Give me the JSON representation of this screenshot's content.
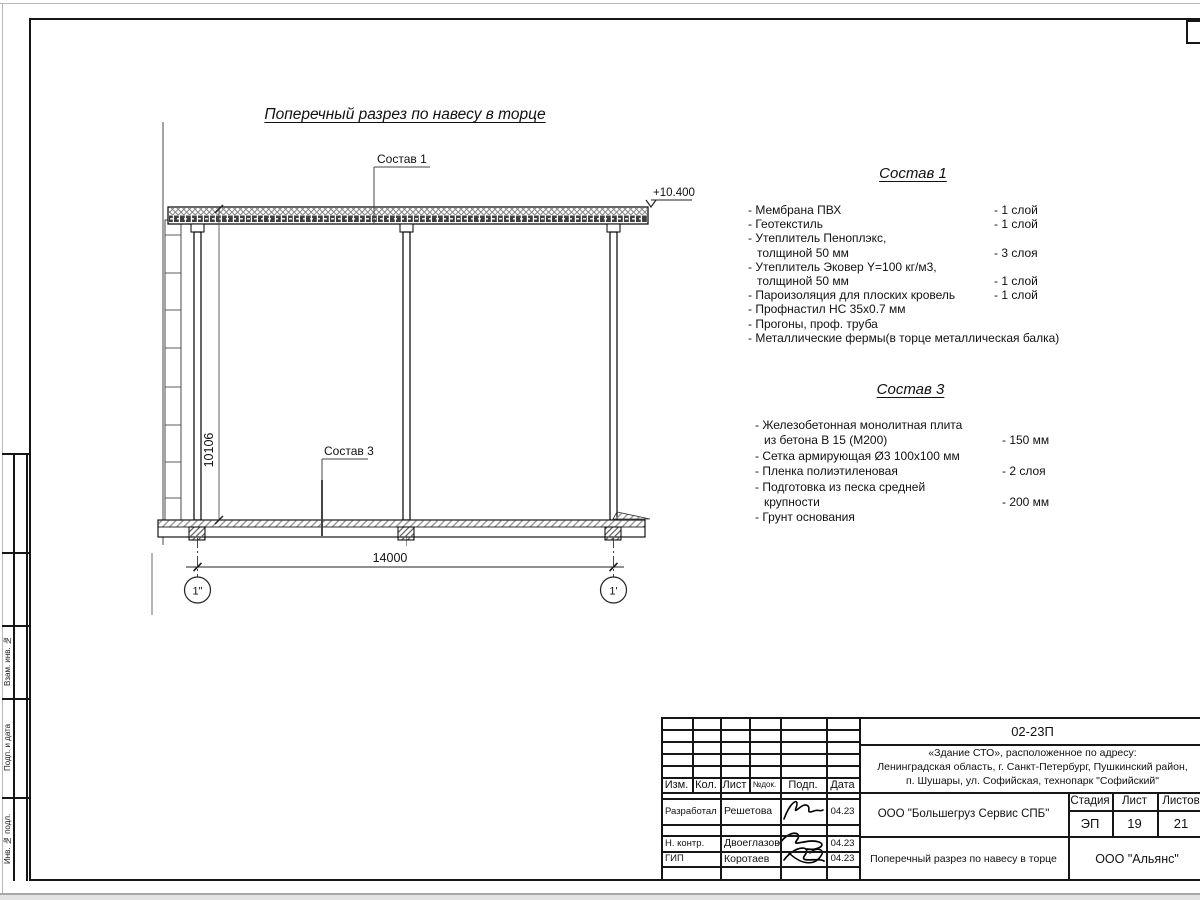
{
  "drawing": {
    "title": "Поперечный разрез по навесу в торце",
    "sostav1_ref": "Состав 1",
    "sostav3_ref": "Состав 3",
    "elevation": "+10.400",
    "dim_width": "14000",
    "dim_height": "10106",
    "axis_left": "1\"",
    "axis_right": "1'"
  },
  "sostav1": {
    "title": "Состав 1",
    "items": [
      {
        "lines": [
          "Мембрана ПВХ"
        ],
        "qty": "- 1 слой"
      },
      {
        "lines": [
          "Геотекстиль"
        ],
        "qty": "- 1 слой"
      },
      {
        "lines": [
          "Утеплитель Пеноплэкс,",
          "толщиной 50 мм"
        ],
        "qty": "- 3 слоя"
      },
      {
        "lines": [
          "Утеплитель Эковер Y=100 кг/м3,",
          "толщиной 50 мм"
        ],
        "qty": "- 1 слой"
      },
      {
        "lines": [
          "Пароизоляция для плоских кровель"
        ],
        "qty": "- 1 слой"
      },
      {
        "lines": [
          "Профнастил НС 35х0.7 мм"
        ],
        "qty": ""
      },
      {
        "lines": [
          "Прогоны, проф. труба"
        ],
        "qty": ""
      },
      {
        "lines": [
          "Металлические фермы(в торце металлическая балка)"
        ],
        "qty": ""
      }
    ]
  },
  "sostav3": {
    "title": "Состав 3",
    "items": [
      {
        "lines": [
          "Железобетонная  монолитная плита",
          "из бетона В 15 (М200)"
        ],
        "qty": "- 150 мм"
      },
      {
        "lines": [
          "Сетка армирующая Ø3 100х100 мм"
        ],
        "qty": ""
      },
      {
        "lines": [
          "Пленка полиэтиленовая"
        ],
        "qty": "-  2 слоя"
      },
      {
        "lines": [
          "Подготовка из песка средней",
          "крупности"
        ],
        "qty": "- 200 мм"
      },
      {
        "lines": [
          "Грунт основания"
        ],
        "qty": ""
      }
    ]
  },
  "titleblock": {
    "doc_number": "02-23П",
    "object_lines": [
      "«Здание СТО», расположенное по адресу:",
      "Ленинградская область, г. Санкт-Петербург, Пушкинский район,",
      "п. Шушары, ул. Софийская, технопарк \"Софийский\""
    ],
    "header": {
      "izm": "Изм.",
      "kol": "Кол.",
      "list": "Лист",
      "ndok": "№док.",
      "podp": "Подп.",
      "data": "Дата"
    },
    "rows": [
      {
        "role": "Разработал",
        "name": "Решетова",
        "date": "04.23"
      },
      {
        "role": "Н. контр.",
        "name": "Двоеглазов",
        "date": "04.23"
      },
      {
        "role": "ГИП",
        "name": "Коротаев",
        "date": "04.23"
      }
    ],
    "org": "ООО \"Большегруз Сервис СПБ\"",
    "stage_label": "Стадия",
    "sheet_label": "Лист",
    "sheets_label": "Листов",
    "stage": "ЭП",
    "sheet": "19",
    "sheets": "21",
    "sheet_title": "Поперечный разрез по навесу в торце",
    "company": "ООО \"Альянс\""
  },
  "side_labels": [
    "Взам. инв. №",
    "Подп. и дата",
    "Инв. № подл."
  ]
}
